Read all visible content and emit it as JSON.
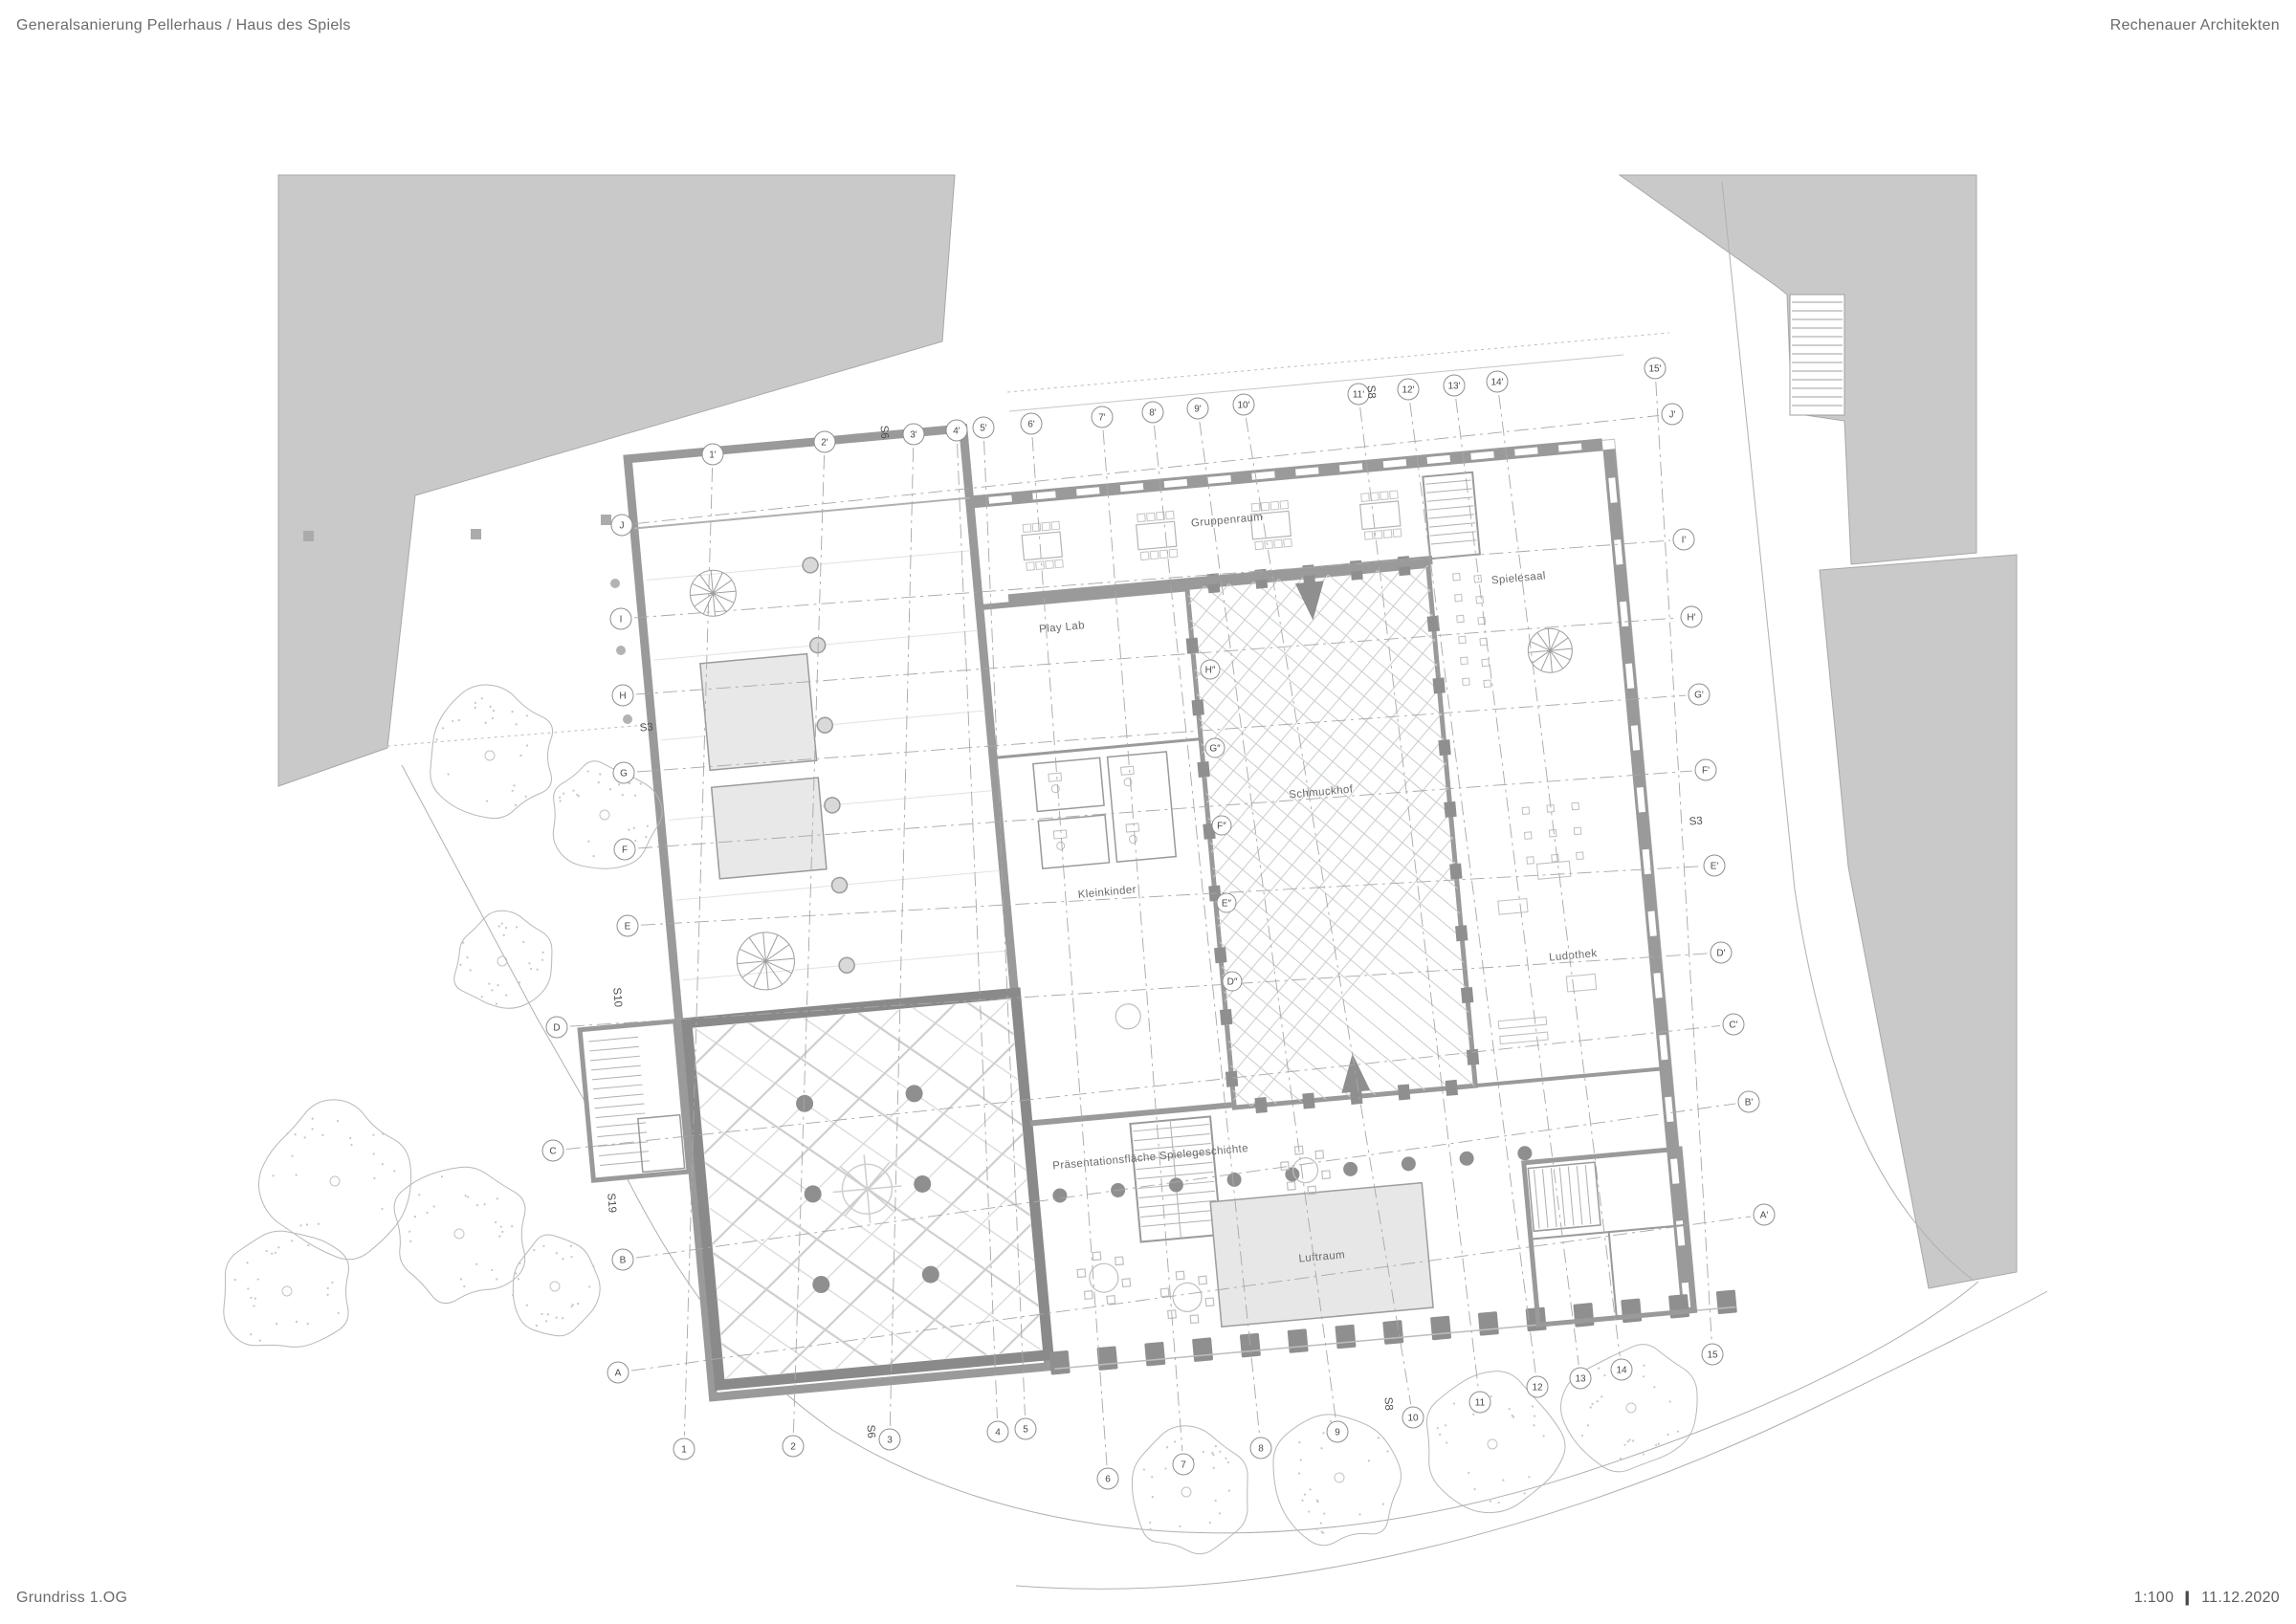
{
  "header": {
    "project_title": "Generalsanierung Pellerhaus / Haus des Spiels",
    "firm": "Rechenauer Architekten"
  },
  "footer": {
    "drawing_title": "Grundriss 1.OG",
    "scale": "1:100",
    "separator": "|",
    "date": "11.12.2020"
  },
  "rooms": {
    "gruppenraum": "Gruppenraum",
    "spielesaal": "Spielesaal",
    "play_lab": "Play Lab",
    "kleinkinder": "Kleinkinder",
    "schmuckhof": "Schmuckhof",
    "ludothek": "Ludothek",
    "praesentation": "Präsentationsfläche Spielegeschichte",
    "luftraum": "Luftraum"
  },
  "grid": {
    "top": [
      "1'",
      "2'",
      "3'",
      "4'",
      "5'",
      "6'",
      "7'",
      "8'",
      "9'",
      "10'",
      "11'",
      "12'",
      "13'",
      "14'",
      "15'"
    ],
    "bottom": [
      "1",
      "2",
      "3",
      "4",
      "5",
      "6",
      "7",
      "8",
      "9",
      "10",
      "11",
      "12",
      "13",
      "14",
      "15"
    ],
    "left": [
      "J",
      "I",
      "H",
      "G",
      "F",
      "E",
      "D",
      "C",
      "B",
      "A"
    ],
    "right": [
      "J'",
      "I'",
      "H'",
      "G'",
      "F'",
      "E'",
      "D'",
      "C'",
      "B'",
      "A'"
    ],
    "inner": [
      "H″",
      "G″",
      "F″",
      "E″",
      "D″"
    ],
    "sections": {
      "s3_left": "S3",
      "s3_right": "S3",
      "s6_top": "S6",
      "s6_bottom": "S6",
      "s8_top": "S8",
      "s8_bottom": "S8",
      "s10": "S10",
      "s19": "S19"
    }
  },
  "colors": {
    "context_gray": "#c9c9c9",
    "wall_gray": "#949494",
    "light_room": "#e8e8e8",
    "rib_gray": "#d4d4d4",
    "line_gray": "#b0b0b0",
    "text_gray": "#5e5e5e"
  }
}
